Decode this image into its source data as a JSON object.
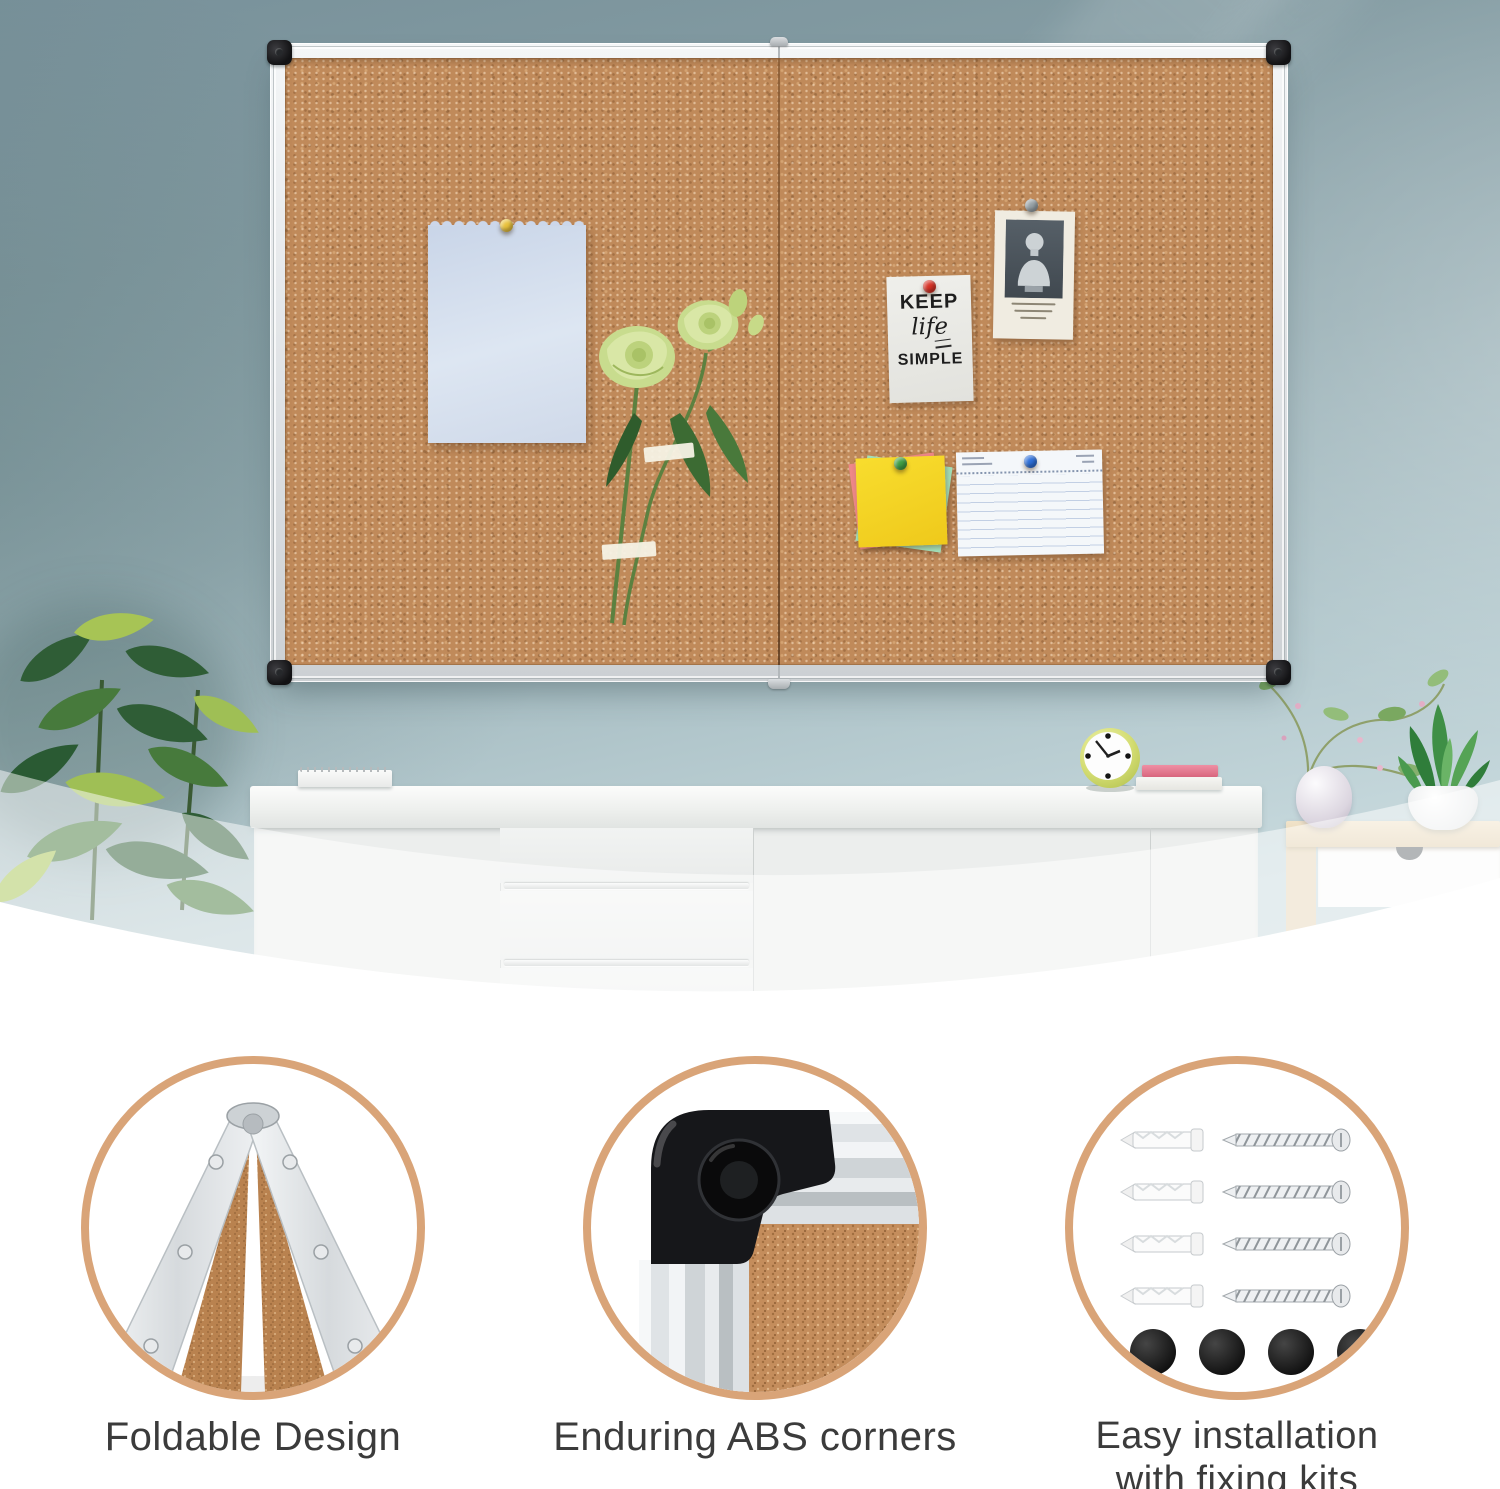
{
  "product": {
    "type": "foldable cork bulletin board product image",
    "board": {
      "panels": 2,
      "frame": "silver aluminum",
      "corners": "black ABS",
      "surface": "cork"
    },
    "note_card": {
      "line1": "KEEP",
      "line2": "life",
      "line3": "SIMPLE"
    }
  },
  "features": [
    {
      "id": "foldable",
      "caption": "Foldable Design",
      "icon": "folded-board-icon"
    },
    {
      "id": "abs-corners",
      "caption": "Enduring ABS corners",
      "icon": "abs-corner-icon"
    },
    {
      "id": "fixing-kits",
      "caption": "Easy installation with fixing kits",
      "lines": [
        "Easy installation",
        "with fixing kits"
      ],
      "icon": "fixing-kit-icon",
      "kit": {
        "anchors": 4,
        "screws": 4,
        "caps": 4
      }
    }
  ],
  "colors": {
    "ring": "#d9a478",
    "wall_top": "#78919a",
    "wall_bottom": "#d3e1e3",
    "cork": "#c08a5a",
    "caption_text": "#3b3b3b"
  }
}
